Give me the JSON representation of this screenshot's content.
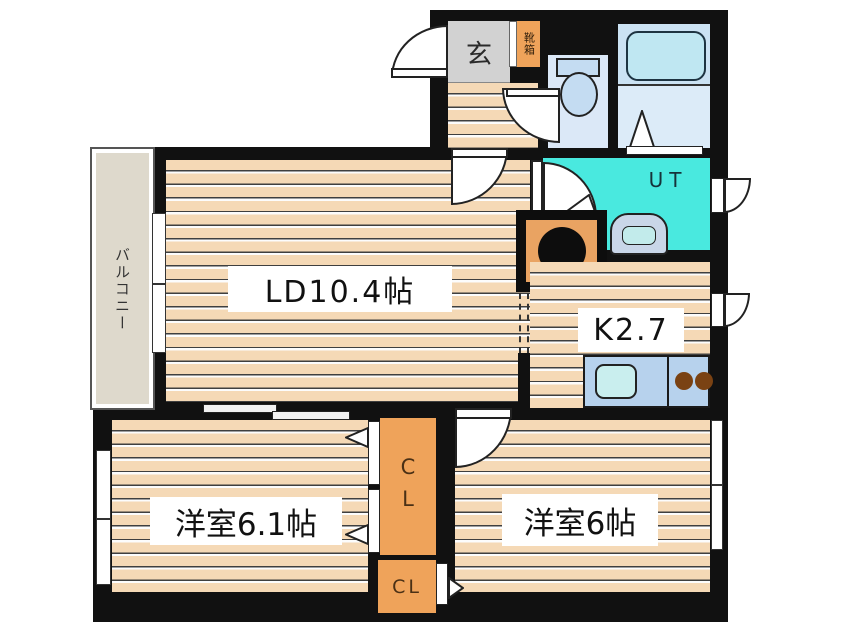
{
  "rooms": {
    "balcony": {
      "label": "バルコニー"
    },
    "entrance": {
      "label": "玄"
    },
    "shoe_box": {
      "label": "靴箱"
    },
    "utility": {
      "label": "UT"
    },
    "living_dining": {
      "label": "LD10.4帖"
    },
    "kitchen": {
      "label": "K2.7"
    },
    "bedroom_left": {
      "label": "洋室6.1帖"
    },
    "bedroom_right": {
      "label": "洋室6帖"
    },
    "closet_upper": {
      "label": "CL"
    },
    "closet_lower": {
      "label": "CL"
    }
  },
  "colors": {
    "wall": "#111111",
    "flooring": "#f5d9b6",
    "balcony": "#ded9cc",
    "entrance_gray": "#d2d2d2",
    "cabinet_orange": "#efa35a",
    "refrigerator_orange": "#e9a362",
    "utility_cyan": "#49e9df",
    "bath_blue": "#d7e7f5",
    "bathtub_blue": "#bfe7f2",
    "toilet_blue": "#dbe8f7",
    "counter_blue": "#b7d2ed",
    "sink_cyan": "#c9eeee",
    "burner_brown": "#7a4213"
  }
}
